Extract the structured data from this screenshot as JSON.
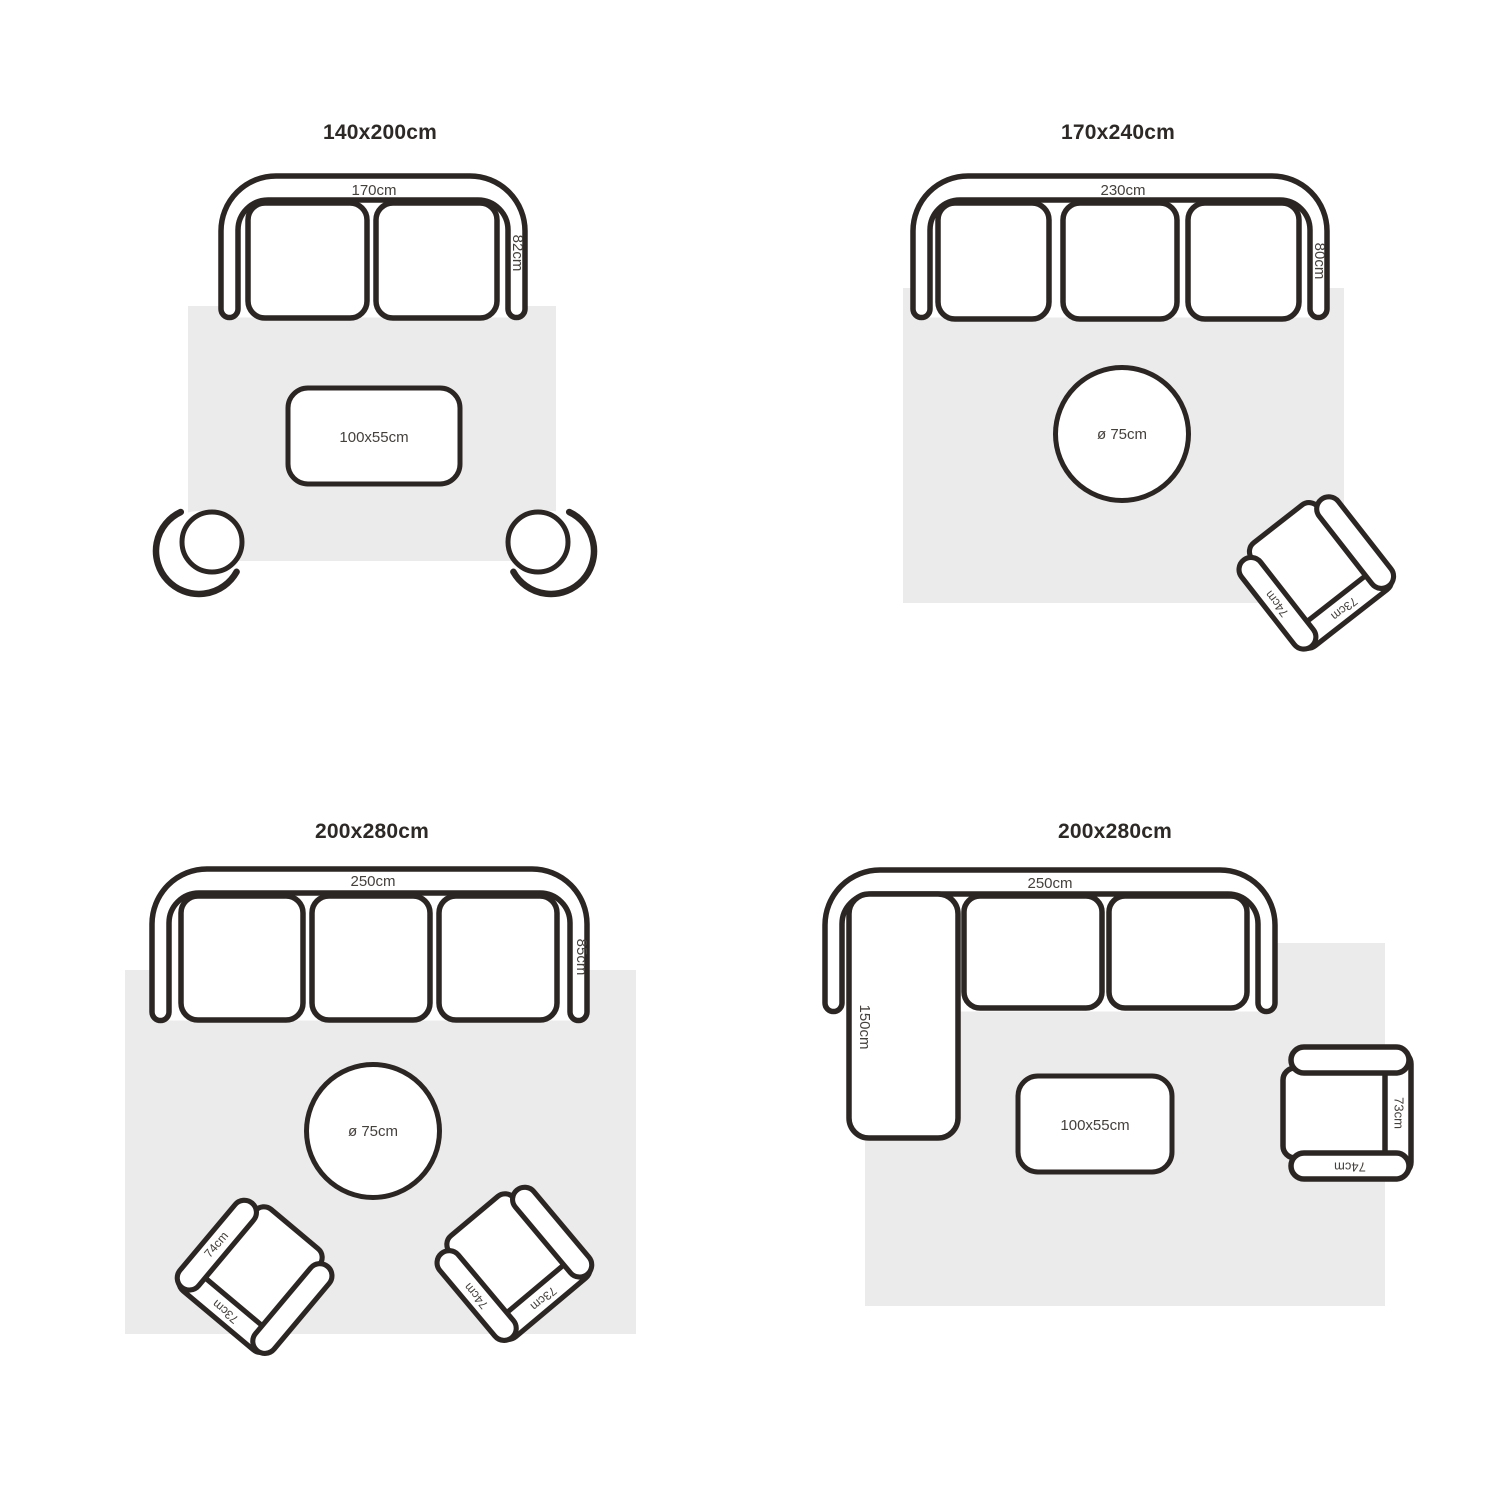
{
  "colors": {
    "background": "#ffffff",
    "line": "#2b2623",
    "rug": "#ebebeb",
    "title_text": "#2c2926",
    "dimension_text": "#44403c"
  },
  "quadrants": [
    {
      "title": "140x200cm",
      "sofa": {
        "width": "170cm",
        "depth": "82cm"
      },
      "coffee_table": {
        "label": "100x55cm"
      }
    },
    {
      "title": "170x240cm",
      "sofa": {
        "width": "230cm",
        "depth": "80cm"
      },
      "round_table": {
        "label": "ø 75cm"
      },
      "armchair": {
        "arm": "74cm",
        "back": "73cm"
      }
    },
    {
      "title": "200x280cm",
      "sofa": {
        "width": "250cm",
        "depth": "85cm"
      },
      "round_table": {
        "label": "ø 75cm"
      },
      "armchair_left": {
        "arm": "74cm",
        "back": "73cm"
      },
      "armchair_right": {
        "arm": "74cm",
        "back": "73cm"
      }
    },
    {
      "title": "200x280cm",
      "sofa": {
        "width": "250cm",
        "chaise": "150cm"
      },
      "coffee_table": {
        "label": "100x55cm"
      },
      "armchair": {
        "arm": "74cm",
        "back": "73cm"
      }
    }
  ]
}
